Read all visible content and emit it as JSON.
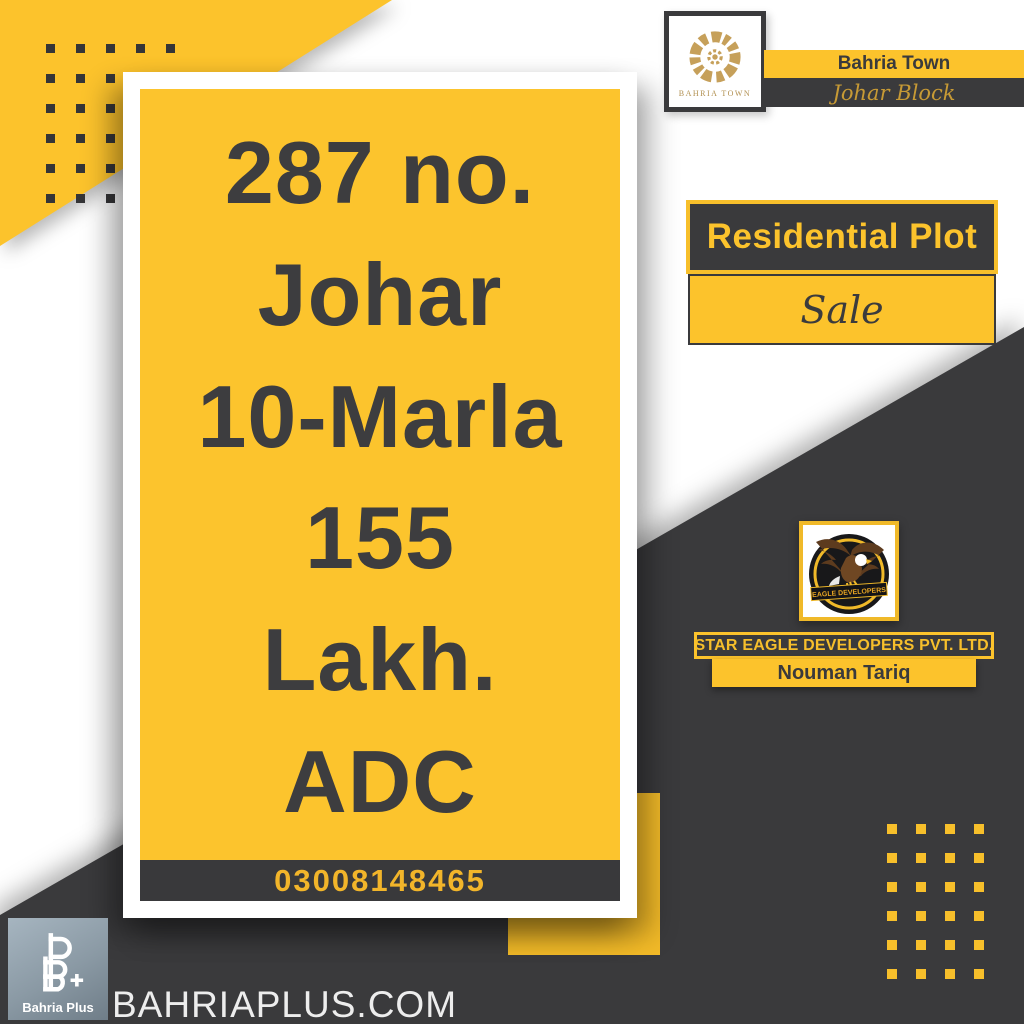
{
  "header": {
    "logo_caption": "BAHRIA TOWN",
    "title": "Bahria Town",
    "subtitle": "Johar Block"
  },
  "listing": {
    "lines": [
      "287 no.",
      "Johar",
      "10-Marla",
      "155",
      "Lakh.",
      "ADC"
    ],
    "phone": "03008148465"
  },
  "offer": {
    "category": "Residential Plot",
    "type": "Sale"
  },
  "developer": {
    "logo_banner": "EAGLE DEVELOPERS",
    "company": "STAR EAGLE DEVELOPERS PVT. LTD.",
    "agent": "Nouman Tariq"
  },
  "footer": {
    "logo_label": "Bahria Plus",
    "website": "BAHRIAPLUS.COM"
  },
  "colors": {
    "yellow": "#fcc32c",
    "dark": "#3a3a3c",
    "gold": "#c6a05a",
    "card_text": "#3d3d3f",
    "phone_text": "#f2b52a",
    "bahria_plus_gray": "#8a99a4"
  }
}
